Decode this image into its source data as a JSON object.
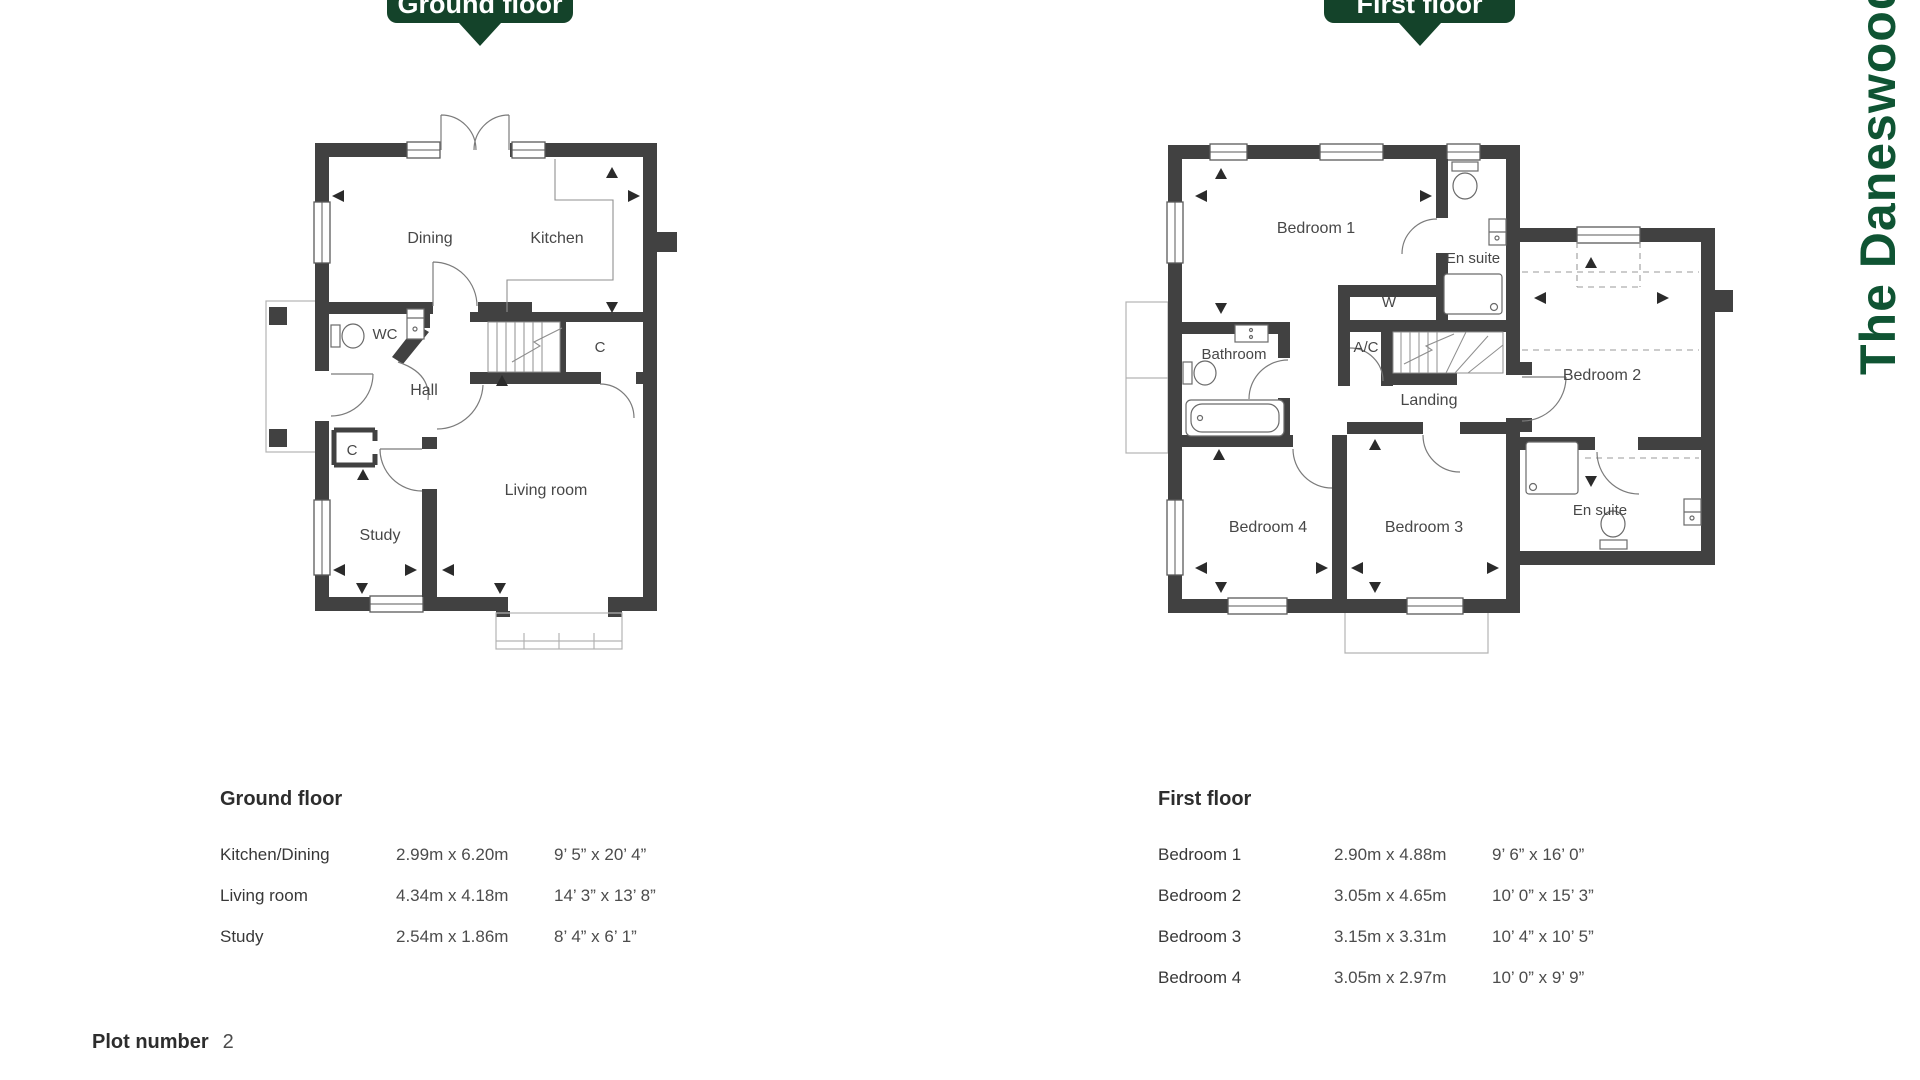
{
  "banners": {
    "ground": "Ground floor",
    "first": "First floor"
  },
  "brand": {
    "vertical_text": "The Daneswood"
  },
  "plans": {
    "ground": {
      "labels": {
        "dining": "Dining",
        "kitchen": "Kitchen",
        "wc": "WC",
        "hall": "Hall",
        "closet_hall": "C",
        "closet_stairs": "C",
        "study": "Study",
        "living": "Living room"
      }
    },
    "first": {
      "labels": {
        "bedroom1": "Bedroom 1",
        "ensuite1": "En suite",
        "wardrobe": "W",
        "bathroom": "Bathroom",
        "ac": "A/C",
        "landing": "Landing",
        "bedroom2": "Bedroom 2",
        "bedroom4": "Bedroom 4",
        "bedroom3": "Bedroom 3",
        "ensuite2": "En suite"
      }
    }
  },
  "tables": {
    "ground": {
      "title": "Ground floor",
      "rows": [
        {
          "room": "Kitchen/Dining",
          "metric": "2.99m x 6.20m",
          "imperial": "9’ 5” x 20’ 4”"
        },
        {
          "room": "Living room",
          "metric": "4.34m x 4.18m",
          "imperial": "14’ 3” x 13’ 8”"
        },
        {
          "room": "Study",
          "metric": "2.54m x 1.86m",
          "imperial": "8’ 4” x 6’ 1”"
        }
      ]
    },
    "first": {
      "title": "First floor",
      "rows": [
        {
          "room": "Bedroom 1",
          "metric": "2.90m x 4.88m",
          "imperial": "9’ 6” x 16’ 0”"
        },
        {
          "room": "Bedroom 2",
          "metric": "3.05m x 4.65m",
          "imperial": "10’ 0” x 15’ 3”"
        },
        {
          "room": "Bedroom 3",
          "metric": "3.15m x 3.31m",
          "imperial": "10’ 4” x 10’ 5”"
        },
        {
          "room": "Bedroom 4",
          "metric": "3.05m x 2.97m",
          "imperial": "10’ 0” x 9’ 9”"
        }
      ]
    }
  },
  "plot": {
    "label": "Plot number",
    "value": "2"
  },
  "colors": {
    "banner_green": "#14432a",
    "brand_green": "#0f5433",
    "wall": "#414141"
  }
}
